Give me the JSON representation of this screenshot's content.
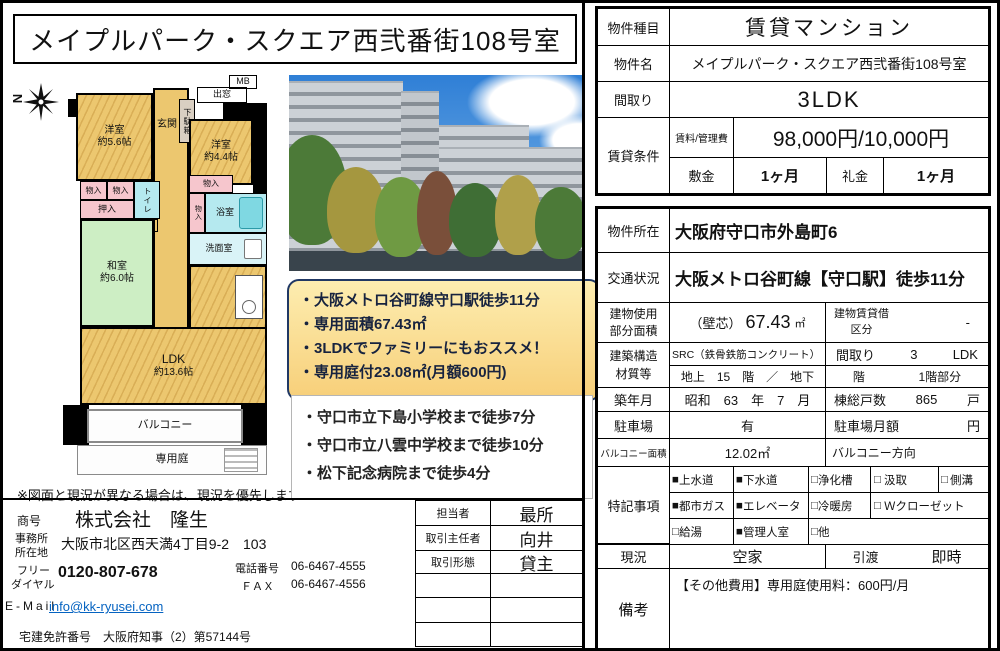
{
  "colors": {
    "highlight_border": "#203864",
    "highlight_fill_top": "#fdedb0",
    "highlight_fill_bottom": "#f7cf79",
    "link_blue": "#0563c1",
    "room_orange": "#ecc76f",
    "room_green": "#cdeec4",
    "room_pink": "#f6c6cd",
    "room_cyan": "#b5e9ef"
  },
  "title": "メイプルパーク・スクエア西弐番街108号室",
  "floorplan": {
    "compass_label": "N",
    "rooms": {
      "yoshitsu56": {
        "name": "洋室",
        "size": "約5.6帖"
      },
      "yoshitsu44": {
        "name": "洋室",
        "size": "約4.4帖"
      },
      "washitsu60": {
        "name": "和室",
        "size": "約6.0帖"
      },
      "ldk": {
        "name": "LDK",
        "size": "約13.6帖"
      },
      "genkan": "玄関",
      "getabako": "下駄箱",
      "demado": "出窓",
      "mb": "MB",
      "monoire": "物入",
      "oshiire": "押入",
      "toilet": "トイレ",
      "ps": "PS",
      "bath": "浴室",
      "senmen": "洗面室",
      "balcony": "バルコニー",
      "garden": "専用庭"
    },
    "note": "※図面と現況が異なる場合は、現況を優先します"
  },
  "highlights": [
    "・大阪メトロ谷町線守口駅徒歩11分",
    "・専用面積67.43㎡",
    "・3LDKでファミリーにもおススメ！",
    "・専用庭付23.08㎡(月額600円)"
  ],
  "nearby": [
    "・守口市立下島小学校まで徒歩7分",
    "・守口市立八雲中学校まで徒歩10分",
    "・松下記念病院まで徒歩4分"
  ],
  "summary": {
    "type_label": "物件種目",
    "type_value": "賃貸マンション",
    "name_label": "物件名",
    "name_value": "メイプルパーク・スクエア西弐番街108号室",
    "layout_label": "間取り",
    "layout_value": "3LDK",
    "terms_label": "賃貸条件",
    "rent_label": "賃料/管理費",
    "rent_value": "98,000円/10,000円",
    "deposit_label": "敷金",
    "deposit_value": "1ヶ月",
    "key_money_label": "礼金",
    "key_money_value": "1ヶ月"
  },
  "detail": {
    "location_label": "物件所在",
    "location_value": "大阪府守口市外島町6",
    "access_label": "交通状況",
    "access_value": "大阪メトロ谷町線【守口駅】徒歩11分",
    "area_label1": "建物使用",
    "area_label2": "部分面積",
    "area_prefix": "（壁芯）",
    "area_num": "67.43",
    "area_unit": "㎡",
    "lease_label1": "建物賃貸借",
    "lease_label2": "区分",
    "lease_value": "-",
    "structure_label1": "建築構造",
    "structure_label2": "材質等",
    "structure_value": "SRC（鉄骨鉄筋コンクリート）",
    "layout_label": "間取り",
    "layout_rooms": "3",
    "layout_type": "LDK",
    "floors_value": "地上　15　階　／　地下",
    "floors_unit": "階",
    "floor_position": "1階部分",
    "built_label": "築年月",
    "built_value": "昭和　63　年　7　月",
    "units_label": "棟総戸数",
    "units_value": "865",
    "units_unit": "戸",
    "parking_label": "駐車場",
    "parking_value": "有",
    "parking_fee_label": "駐車場月額",
    "parking_fee_unit": "円",
    "balcony_area_label": "バルコニー面積",
    "balcony_area_value": "12.02㎡",
    "balcony_dir_label": "バルコニー方向",
    "features_label": "特記事項",
    "features": {
      "r1c1": {
        "box": "■",
        "label": "上水道"
      },
      "r1c2": {
        "box": "■",
        "label": "下水道"
      },
      "r1c3": {
        "box": "□",
        "label": "浄化槽"
      },
      "r1c4": {
        "box": "□",
        "label": "汲取"
      },
      "r1c5": {
        "box": "□",
        "label": "側溝"
      },
      "r2c1": {
        "box": "■",
        "label": "都市ガス"
      },
      "r2c2": {
        "box": "■",
        "label": "エレベータ"
      },
      "r2c3": {
        "box": "□",
        "label": "冷暖房"
      },
      "r2c4": {
        "box": "□",
        "label": "Ｗクローゼット"
      },
      "r3c1": {
        "box": "□",
        "label": "給湯"
      },
      "r3c2": {
        "box": "■",
        "label": "管理人室"
      },
      "r3c3": {
        "box": "□",
        "label": "他"
      }
    },
    "status_label": "現況",
    "status_value": "空家",
    "handover_label": "引渡",
    "handover_value": "即時",
    "remarks_label": "備考",
    "remarks_value": "【その他費用】専用庭使用料：600円/月"
  },
  "company": {
    "name_label": "商号",
    "name_value": "株式会社　隆生",
    "office_label1": "事務所",
    "office_label2": "所在地",
    "office_value": "大阪市北区西天満4丁目9-2　103",
    "freedial_label1": "フリー",
    "freedial_label2": "ダイヤル",
    "freedial_value": "0120-807-678",
    "tel_label": "電話番号",
    "tel_value": "06-6467-4555",
    "fax_label": "ＦＡＸ",
    "fax_value": "06-6467-4556",
    "email_label": "E-Mail",
    "email_value": "info@kk-ryusei.com",
    "license_label": "宅建免許番号",
    "license_value": "大阪府知事（2）第57144号"
  },
  "agent": {
    "staff_label": "担当者",
    "staff_value": "最所",
    "chief_label": "取引主任者",
    "chief_value": "向井",
    "type_label": "取引形態",
    "type_value": "貸主"
  }
}
